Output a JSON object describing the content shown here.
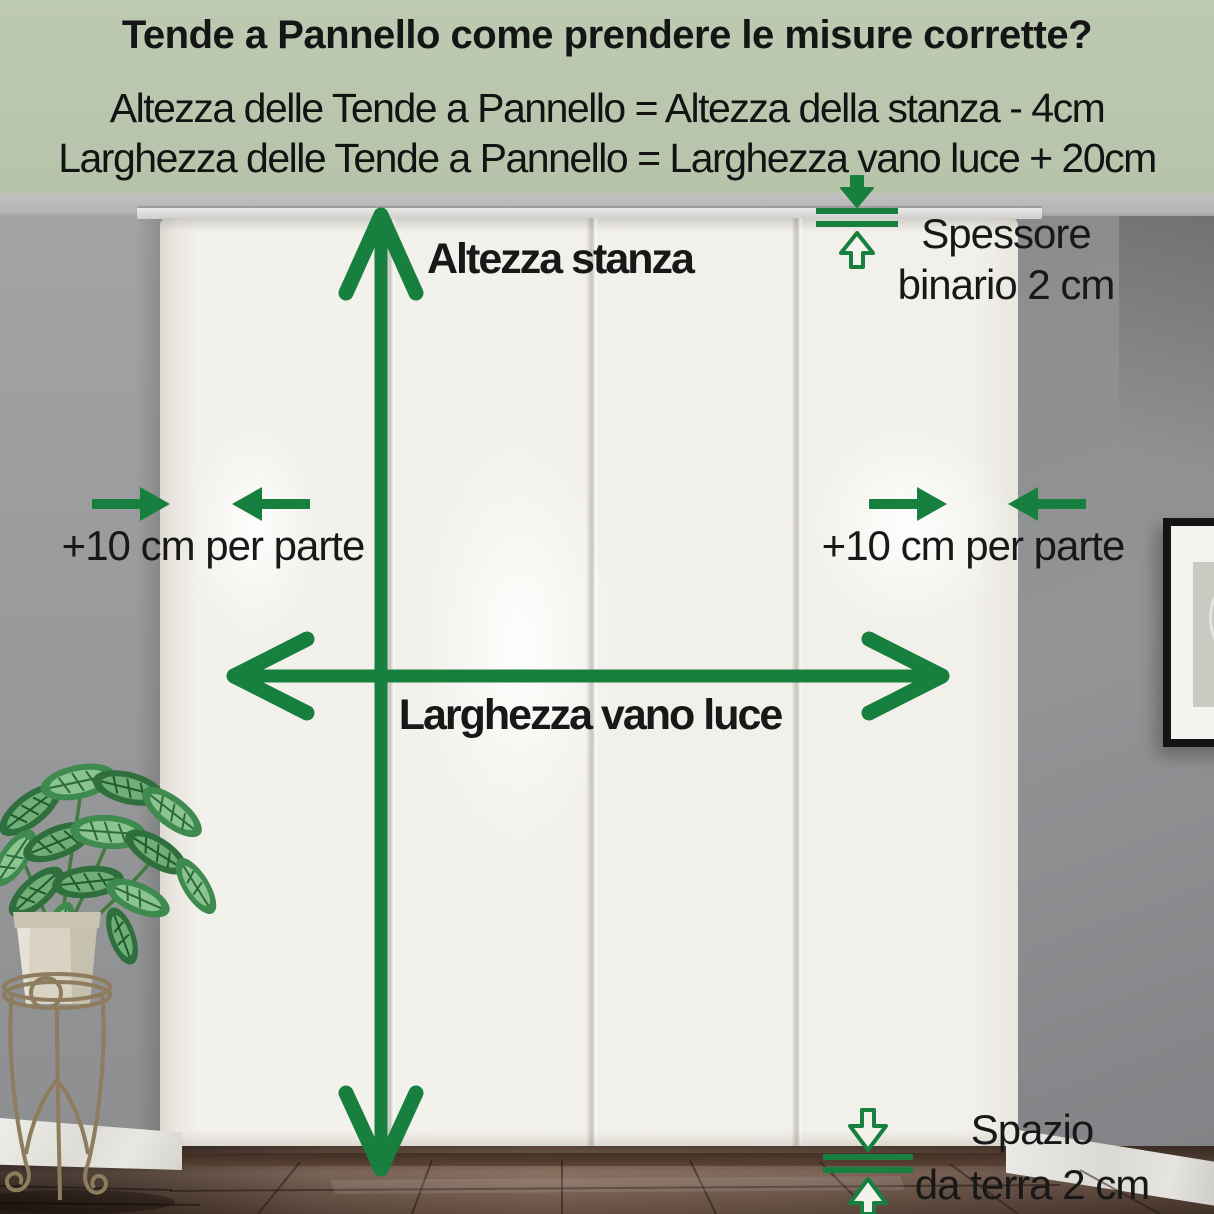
{
  "header": {
    "title": "Tende a Pannello come prendere le misure corrette?",
    "formula_height": "Altezza delle Tende a Pannello = Altezza della stanza - 4cm",
    "formula_width": "Larghezza delle Tende a Pannello = Larghezza vano luce + 20cm"
  },
  "annotations": {
    "room_height": "Altezza stanza",
    "opening_width": "Larghezza vano luce",
    "side_allowance_left": "+10 cm per parte",
    "side_allowance_right": "+10 cm per parte",
    "track_thickness_line1": "Spessore",
    "track_thickness_line2": "binario 2 cm",
    "floor_gap_line1": "Spazio",
    "floor_gap_line2": "da terra 2 cm"
  },
  "colors": {
    "accent_green": "#17803e",
    "header_bg": "#b8c6ac",
    "text": "#151515",
    "wall_gray": "#97989a",
    "curtain_white": "#f2f0ea",
    "floor_brown": "#6a5244",
    "frame_black": "#141414"
  }
}
